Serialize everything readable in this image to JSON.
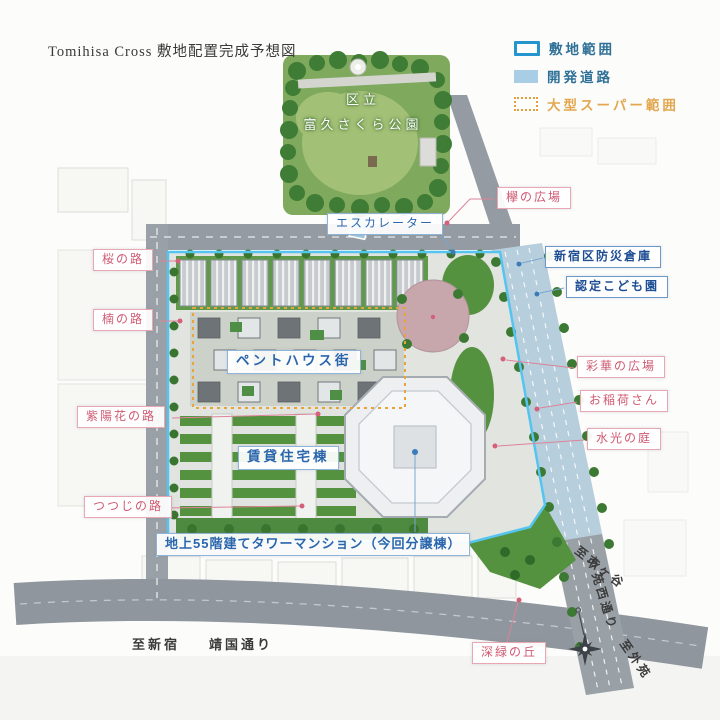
{
  "title": "Tomihisa Cross 敷地配置完成予想図",
  "legend": {
    "items": [
      {
        "id": "site-extent",
        "label": "敷地範囲",
        "swatch": "blue-outline",
        "color": "#2496cd"
      },
      {
        "id": "development-road",
        "label": "開発道路",
        "swatch": "lightblue-fill",
        "color": "#a9cde4"
      },
      {
        "id": "supermarket-extent",
        "label": "大型スーパー範囲",
        "swatch": "orange-dotted",
        "color": "#e2a03c"
      }
    ]
  },
  "park": {
    "name_line1": "区立",
    "name_line2": "富久さくら公園"
  },
  "facility_labels": {
    "escalator": "エスカレーター",
    "disaster_warehouse": "新宿区防災倉庫",
    "kindergarten": "認定こども園",
    "penthouse_street": "ペントハウス街",
    "rental_residence": "賃貸住宅棟",
    "tower": "地上55階建てタワーマンション（今回分譲棟）"
  },
  "place_labels": {
    "sakura_path": "桜の路",
    "kusunoki_path": "楠の路",
    "ajisai_path": "紫陽花の路",
    "tsutsuji_path": "つつじの路",
    "keyaki_plaza": "欅の広場",
    "saika_plaza": "彩華の広場",
    "oinari_san": "お稲荷さん",
    "suiko_garden": "水光の庭",
    "shinryoku_hill": "深緑の丘"
  },
  "road_labels": {
    "to_shinjuku": "至新宿",
    "yasukuni_dori": "靖国通り",
    "to_ichigaya": "至市ヶ谷",
    "gaien_nishi_dori": "外苑西通り",
    "to_gaien": "至外苑"
  },
  "colors": {
    "site_outline": "#55c4ef",
    "development_road": "#b7cedc",
    "supermarket_outline": "#e8a33d",
    "pink_label": "#cf5a72",
    "blue_label": "#2b66ad",
    "park_green": "#7fa95c",
    "road_gray": "#8f969d"
  }
}
